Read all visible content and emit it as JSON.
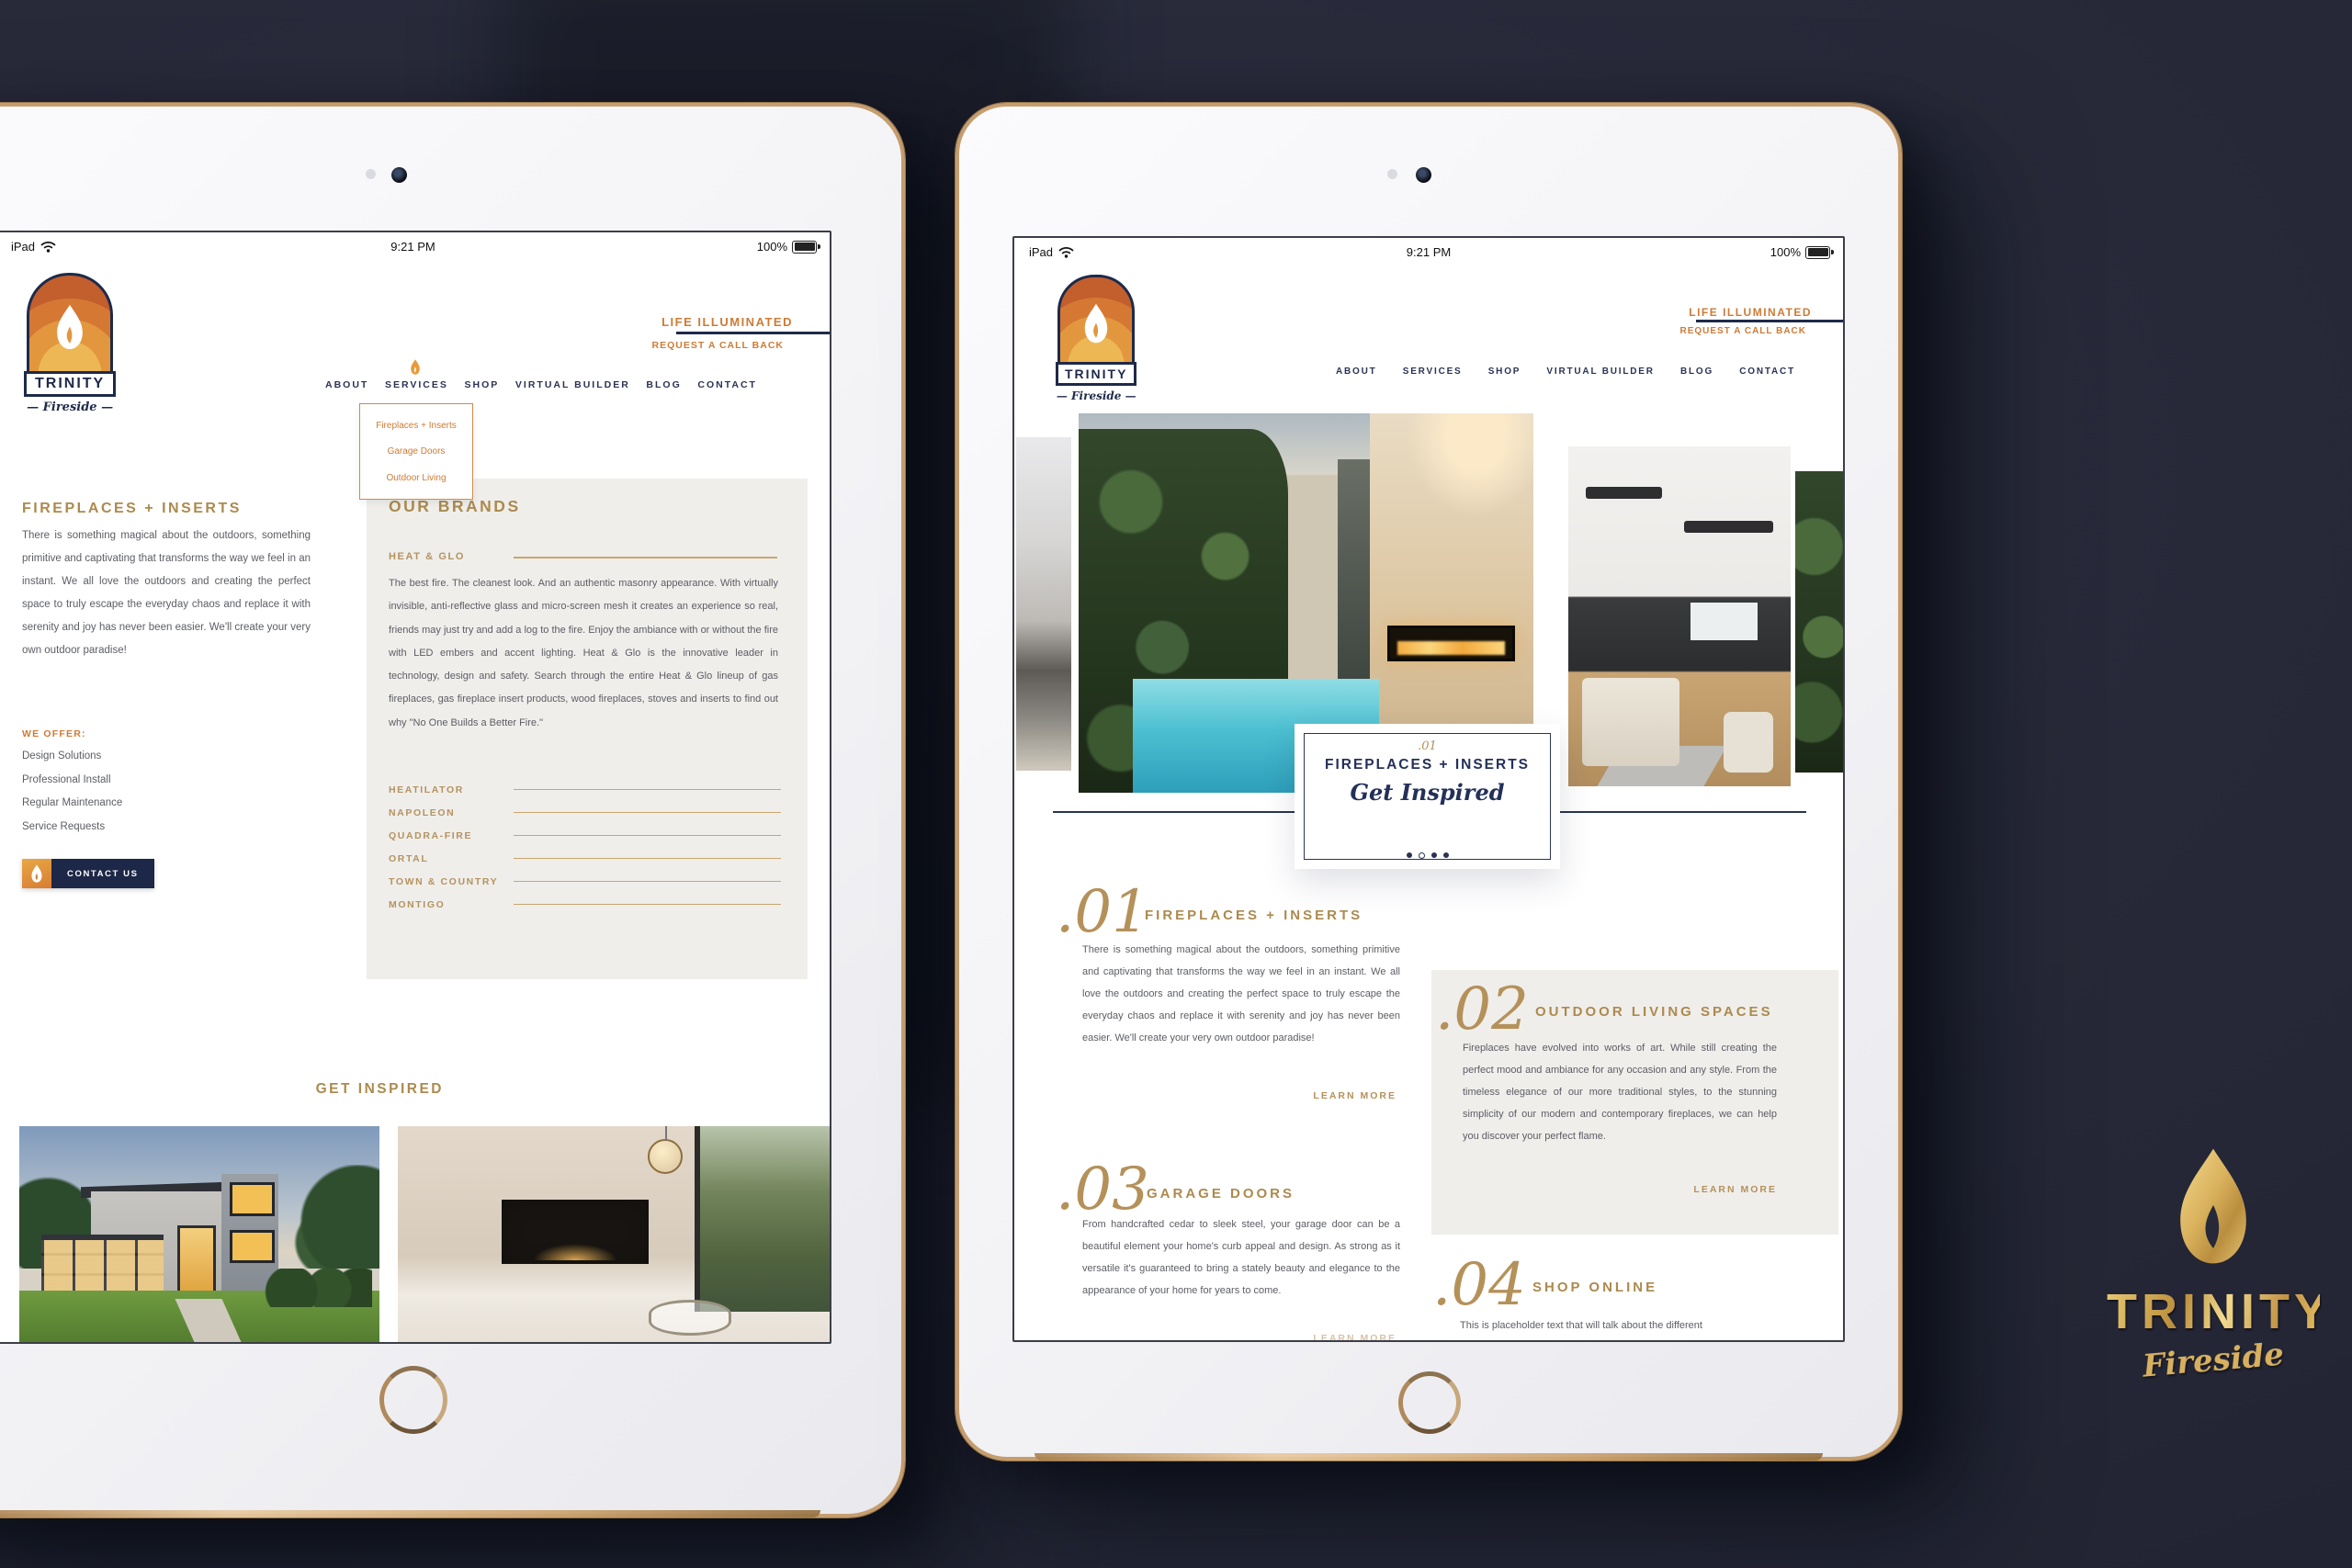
{
  "brand": {
    "name": "TRINITY",
    "logo_subtitle": "— Fireside —",
    "foil_script": "Fireside"
  },
  "status_bar": {
    "device": "iPad",
    "time": "9:21 PM",
    "battery": "100%"
  },
  "nav": {
    "items": [
      "ABOUT",
      "SERVICES",
      "SHOP",
      "VIRTUAL BUILDER",
      "BLOG",
      "CONTACT"
    ]
  },
  "header": {
    "tagline": "LIFE ILLUMINATED",
    "cta": "REQUEST A CALL BACK"
  },
  "services_dropdown": {
    "items": [
      "Fireplaces + Inserts",
      "Garage Doors",
      "Outdoor Living"
    ]
  },
  "left_page": {
    "title": "FIREPLACES + INSERTS",
    "intro": "There is something magical about the outdoors, something primitive and captivating that transforms the way we feel in an instant. We all love the outdoors and creating the perfect space to truly escape the everyday chaos and replace it with serenity and joy has never been easier. We'll create your very own outdoor paradise!",
    "offer_label": "WE OFFER:",
    "offers": [
      "Design Solutions",
      "Professional Install",
      "Regular Maintenance",
      "Service Requests"
    ],
    "contact_label": "CONTACT US",
    "brands_title": "OUR BRANDS",
    "featured_brand": "HEAT & GLO",
    "featured_text": "The best fire. The cleanest look. And an authentic masonry appearance. With virtually invisible, anti-reflective glass and micro-screen mesh it creates an experience so real, friends may just try and add a log to the fire. Enjoy the ambiance with or without the fire with LED embers and accent lighting. Heat & Glo is the innovative leader in technology, design and safety. Search through the entire Heat & Glo lineup of gas fireplaces, gas fireplace insert products, wood fireplaces, stoves and inserts to find out why \"No One Builds a Better Fire.\"",
    "brands": [
      "HEATILATOR",
      "NAPOLEON",
      "QUADRA-FIRE",
      "ORTAL",
      "TOWN & COUNTRY",
      "MONTIGO"
    ],
    "inspired_title": "GET INSPIRED"
  },
  "right_page": {
    "hero": {
      "number": ".01",
      "title": "FIREPLACES + INSERTS",
      "script": "Get Inspired"
    },
    "sections": [
      {
        "num": ".01",
        "title": "FIREPLACES + INSERTS",
        "text": "There is something magical about the outdoors, something primitive and captivating that transforms the way we feel in an instant. We all love the outdoors and creating the perfect space to truly escape the everyday chaos and replace it with serenity and joy has never been easier. We'll create your very own outdoor paradise!",
        "link": "LEARN MORE"
      },
      {
        "num": ".02",
        "title": "OUTDOOR LIVING SPACES",
        "text": "Fireplaces have evolved into works of art. While still creating the perfect mood and ambiance for any occasion and any style. From the timeless elegance of our more traditional styles, to the stunning simplicity of our modern and contemporary fireplaces, we can help you discover your perfect flame.",
        "link": "LEARN MORE"
      },
      {
        "num": ".03",
        "title": "GARAGE DOORS",
        "text": "From handcrafted cedar to sleek steel, your garage door can be a beautiful element your home's curb appeal and design. As strong as it versatile it's guaranteed to bring a stately beauty and elegance to the appearance of your home for years to come.",
        "link": "LEARN MORE"
      },
      {
        "num": ".04",
        "title": "SHOP ONLINE",
        "text": "This is placeholder text that will talk about the different",
        "link": ""
      }
    ]
  },
  "colors": {
    "accent_orange": "#ce7b36",
    "gold": "#ac8a4e",
    "navy": "#1e2a49",
    "panel_gray": "#efeeeb",
    "backdrop": "#272939"
  }
}
